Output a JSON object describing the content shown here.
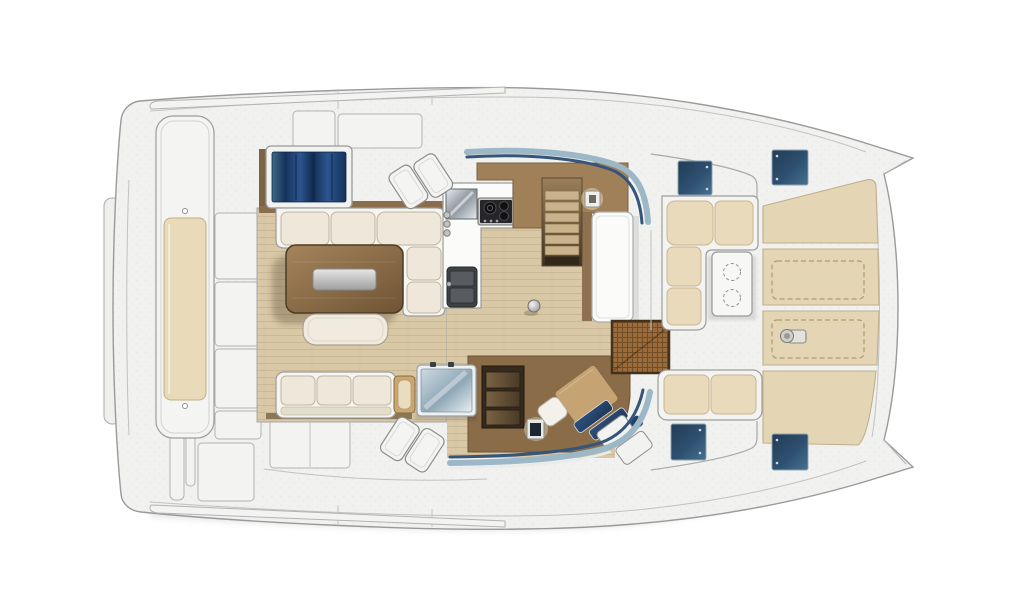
{
  "document": {
    "kind": "catamaran-deck-plan",
    "description": "Top-view interior deck plan of a catamaran; bow with twin hull tips at right, stern bench at left, salon with galley, dinette, navigation station, forward cockpit and foredeck sunpads.",
    "visible_text": []
  },
  "palette": {
    "bg": "#ffffff",
    "hull": "#f1f1ef",
    "hull_stroke": "#9a9a9a",
    "deck_line": "#c4c4c4",
    "panel": "#f3f3f2",
    "panel_stroke": "#b1b1b0",
    "cushion": "#e9dab9",
    "cushion_stroke": "#c7b28c",
    "sunpad": "#e4d6b5",
    "sunpad_stroke": "#bfae8a",
    "sofa_base": "#f6f5f2",
    "sofa_cushion": "#efe8da",
    "wood_floor": "#d8c8a6",
    "wood_floor_line": "#a98d62",
    "walnut": "#8a6c49",
    "sideboard": "#8b6d4b",
    "brown_wall": "#a08059",
    "brown_wall_stroke": "#7c5f3e",
    "table_light": "#a5845c",
    "table_dark": "#6f5434",
    "tray_light": "#e6e6e6",
    "tray_dark": "#9e9e9e",
    "stair_light": "#c9b28c",
    "stair_top": "#9a7f5b",
    "stair_dark": "#3e3120",
    "shelf_dark": "#352a1d",
    "shelf_slot_light": "#7a6345",
    "shelf_slot_dark": "#4a3a26",
    "mat": "#9a6c3b",
    "mat_stroke": "#45301b",
    "hatch_dark": "#223c55",
    "hatch_mid": "#2e5070",
    "hatch_light": "#47708f",
    "hatch_stroke": "#8fa3b3",
    "glass_teal": "#3d6a85",
    "glass_navy_dark": "#122c52",
    "glass_navy": "#16325b",
    "glass_blue": "#2c5690",
    "glaze_edge": "#9cb7c6",
    "glaze_core": "#35567a",
    "icebox_glass_a": "#ccd9e2",
    "icebox_glass_b": "#8fa7b6",
    "icebox_glass_c": "#e8f0f4",
    "white_furniture": "#fbfbfa",
    "steel_a": "#e8ebed",
    "steel_b": "#8b959d",
    "stove_panel": "#26262a",
    "sink_body": "#3f4245",
    "sink_basin": "#585c60",
    "nav_tread_a": "#30517c",
    "nav_tread_b": "#1d3557",
    "side_table": "#c9a76e",
    "side_table_inset": "#e9dcbf"
  },
  "zones": {
    "salon": "salon",
    "galley": "galley",
    "dinette": "dinette",
    "navigation": "navigation-station",
    "forward_cockpit": "forward-cockpit",
    "foredeck": "foredeck-sunpads",
    "aft_bench": "stern-bench",
    "stairs_starboard": "starboard-hull-stairs",
    "stairs_port": "port-hull-steps",
    "entry": "entry-mat"
  },
  "counts": {
    "deck_hatches": 4,
    "roof_hatch_pairs": 2,
    "stove_burners": 3,
    "table_cupholders": 2,
    "stair_treads": 6,
    "sunpad_panels": 4,
    "bench_cushions_dinette": 3,
    "bench_cushions_lounge": 3
  }
}
